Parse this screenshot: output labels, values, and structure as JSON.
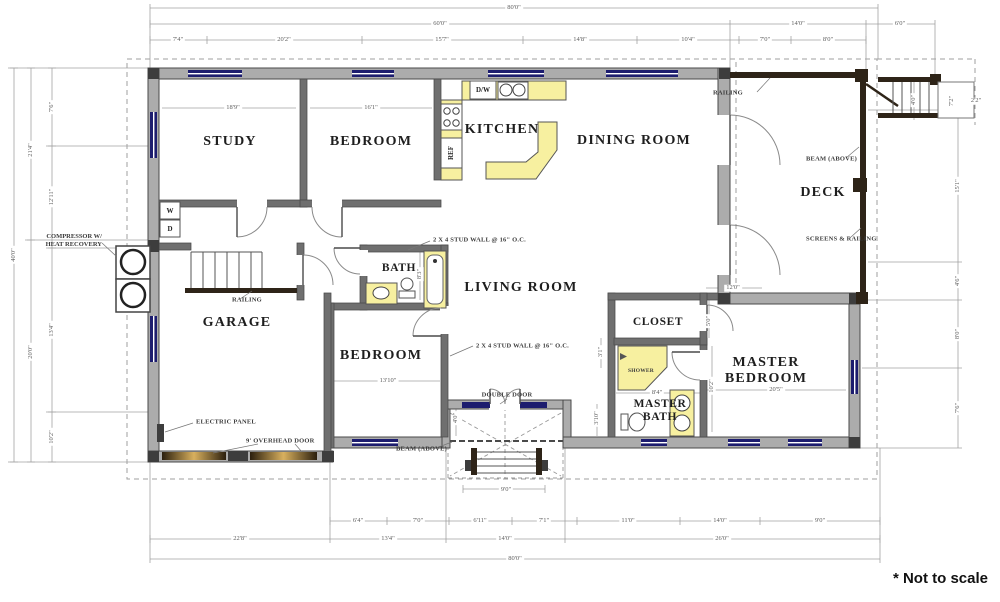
{
  "rooms": {
    "study": "STUDY",
    "bedroom1": "BEDROOM",
    "kitchen": "KITCHEN",
    "dining": "DINING ROOM",
    "deck": "DECK",
    "bath": "BATH",
    "living": "LIVING ROOM",
    "garage": "GARAGE",
    "bedroom2": "BEDROOM",
    "closet": "CLOSET",
    "master_bedroom": "MASTER BEDROOM",
    "master_bath": "MASTER BATH"
  },
  "annotations": {
    "stud_wall_bath": "2 X 4 STUD WALL @ 16\" O.C.",
    "stud_wall_living": "2 X 4 STUD WALL @ 16\" O.C.",
    "compressor": "COMPRESSOR W/ HEAT RECOVERY",
    "electric_panel": "ELECTRIC PANEL",
    "overhead_door": "9' OVERHEAD DOOR",
    "railing_garage": "RAILING",
    "railing_deck": "RAILING",
    "beam_deck": "BEAM (ABOVE)",
    "beam_entry": "BEAM (ABOVE)",
    "screens_railing": "SCREENS & RAILING",
    "double_door": "DOUBLE DOOR",
    "shower": "SHOWER",
    "dishwasher": "D/W",
    "refrigerator": "REF",
    "washer": "W",
    "dryer": "D"
  },
  "dims": {
    "top": {
      "overall": "80'0\"",
      "row2": [
        "60'0\"",
        "14'0\"",
        "6'0\""
      ],
      "row3": [
        "7'4\"",
        "20'2\"",
        "15'7\"",
        "14'8\"",
        "10'4\"",
        "7'0\"",
        "8'0\""
      ]
    },
    "bottom": {
      "overall": "80'0\"",
      "row2": [
        "22'8\"",
        "13'4\"",
        "14'0\"",
        "26'0\""
      ],
      "row3": [
        "6'4\"",
        "7'0\"",
        "6'11\"",
        "7'1\"",
        "11'0\"",
        "14'0\"",
        "9'0\""
      ]
    },
    "left": {
      "overall": "40'0\"",
      "mid": [
        "21'4\"",
        "20'0\""
      ],
      "inner": [
        "7'6\"",
        "12'11\"",
        "13'4\"",
        "10'2\""
      ]
    },
    "right": {
      "inner": [
        "15'1\"",
        "4'6\"",
        "8'0\"",
        "7'6\""
      ],
      "stair": "4'0\"",
      "landing": "7'2\"",
      "offset": "2'2\""
    },
    "interior": {
      "study": "18'9\"",
      "bedroom1": "16'1\"",
      "bedroom2": "13'10\"",
      "master": "20'5\"",
      "suite": "12'0\"",
      "master_bath": "8'4\"",
      "master_bath_side": "10'2\"",
      "closet_door": "5'0\"",
      "hall": "3'1\"",
      "bath": "8'3\"",
      "entry_depth": "4'0\"",
      "entry_side": "3'10\"",
      "steps": "9'0\""
    }
  },
  "footnote": "* Not to scale",
  "colors": {
    "wall_fill": "#acacac",
    "wall_dark": "#3d3d3d",
    "window": "#1c1c6e",
    "fixture": "#f7f0a0",
    "beam": "#2e2418",
    "dim_line": "#9a9a9a"
  }
}
